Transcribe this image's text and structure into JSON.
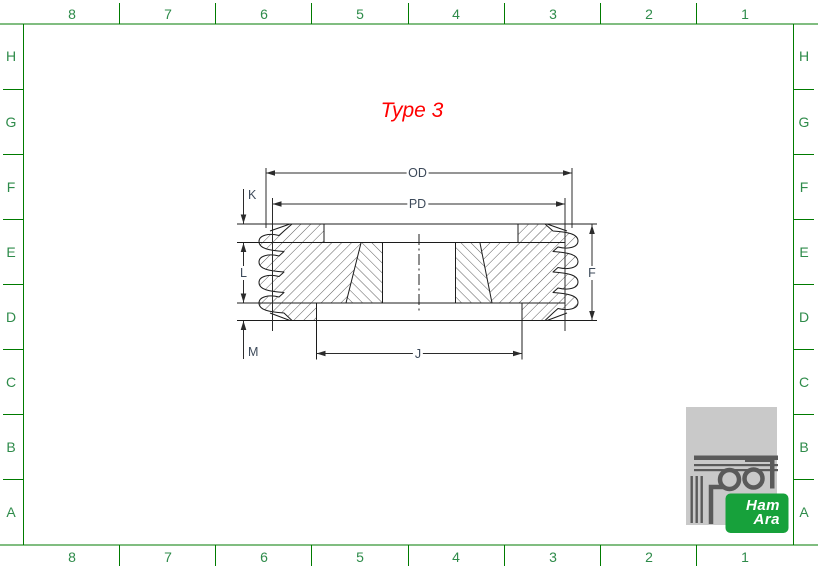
{
  "sheet": {
    "title": "Type 3",
    "grid": {
      "columns": [
        "8",
        "7",
        "6",
        "5",
        "4",
        "3",
        "2",
        "1"
      ],
      "rows": [
        "H",
        "G",
        "F",
        "E",
        "D",
        "C",
        "B",
        "A"
      ]
    },
    "dimensions": {
      "od": "OD",
      "pd": "PD",
      "k": "K",
      "l": "L",
      "m": "M",
      "f": "F",
      "j": "J"
    },
    "logo": {
      "line1": "Ham",
      "line2": "Ara"
    },
    "colors": {
      "frame_green": "#007b00",
      "grid_text_green": "#2e8b4a",
      "title_red": "#ff0000",
      "dim_label_slate": "#3d4a5a",
      "part_line": "#1c1c1c",
      "logo_badge_green": "#17a13b",
      "logo_square_gray": "#c9c9c9",
      "logo_glyph_gray": "#5a5a5a"
    }
  }
}
